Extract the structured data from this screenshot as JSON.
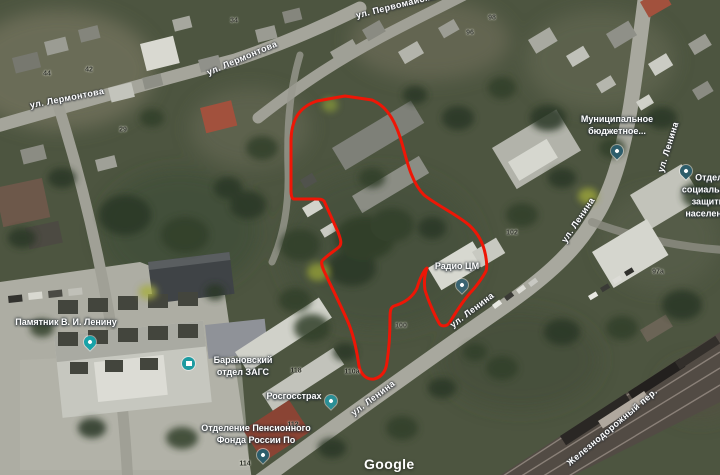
{
  "map": {
    "attribution": "Google",
    "parcel_outline_color": "#ee1606",
    "street_labels": [
      {
        "text": "ул. Лермонтова",
        "x": 67,
        "y": 98,
        "rot": -11
      },
      {
        "text": "ул. Лермонтова",
        "x": 242,
        "y": 58,
        "rot": -23
      },
      {
        "text": "ул. Первомайская",
        "x": 398,
        "y": 5,
        "rot": -14
      },
      {
        "text": "ул. Ленина",
        "x": 668,
        "y": 147,
        "rot": -73
      },
      {
        "text": "ул. Ленина",
        "x": 578,
        "y": 220,
        "rot": -56
      },
      {
        "text": "ул. Ленина",
        "x": 472,
        "y": 310,
        "rot": -37
      },
      {
        "text": "ул. Ленина",
        "x": 373,
        "y": 398,
        "rot": -37
      },
      {
        "text": "Железнодорожный пер.",
        "x": 612,
        "y": 427,
        "rot": -40
      }
    ],
    "house_numbers": [
      {
        "text": "44",
        "x": 47,
        "y": 74
      },
      {
        "text": "42",
        "x": 89,
        "y": 70
      },
      {
        "text": "34",
        "x": 234,
        "y": 21
      },
      {
        "text": "29",
        "x": 123,
        "y": 130
      },
      {
        "text": "96",
        "x": 470,
        "y": 33
      },
      {
        "text": "98",
        "x": 492,
        "y": 18
      },
      {
        "text": "102",
        "x": 512,
        "y": 233
      },
      {
        "text": "97а",
        "x": 658,
        "y": 272
      },
      {
        "text": "100",
        "x": 401,
        "y": 326
      },
      {
        "text": "110а",
        "x": 352,
        "y": 372
      },
      {
        "text": "118",
        "x": 296,
        "y": 371
      },
      {
        "text": "112",
        "x": 293,
        "y": 425
      },
      {
        "text": "114",
        "x": 245,
        "y": 464
      }
    ],
    "poi": [
      {
        "label": "Муниципальное\nбюджетное...",
        "x": 617,
        "y": 125,
        "pin_x": 617,
        "pin_y": 158,
        "pin_style": "drop",
        "color": "#2d5d6b"
      },
      {
        "label": "Отдел социальной\nзащиты населения",
        "x": 709,
        "y": 196,
        "pin_x": 686,
        "pin_y": 178,
        "pin_style": "drop",
        "color": "#2d5d6b"
      },
      {
        "label": "Памятник В. И. Ленину",
        "x": 66,
        "y": 322,
        "pin_x": 90,
        "pin_y": 349,
        "pin_style": "drop",
        "color": "#17a2a8"
      },
      {
        "label": "Барановский\nотдел ЗАГС",
        "x": 243,
        "y": 366,
        "pin_x": 189,
        "pin_y": 364,
        "pin_style": "circle",
        "color": "#1d9ba1"
      },
      {
        "label": "Росгосстрах",
        "x": 294,
        "y": 396,
        "pin_x": 331,
        "pin_y": 408,
        "pin_style": "drop",
        "color": "#2b8f96"
      },
      {
        "label": "Радио ЦМ",
        "x": 457,
        "y": 266,
        "pin_x": 462,
        "pin_y": 292,
        "pin_style": "drop",
        "color": "#3a6472"
      },
      {
        "label": "Отделение Пенсионного\nФонда России По",
        "x": 256,
        "y": 434,
        "pin_x": 263,
        "pin_y": 462,
        "pin_style": "drop",
        "color": "#2d5d6b"
      }
    ]
  }
}
